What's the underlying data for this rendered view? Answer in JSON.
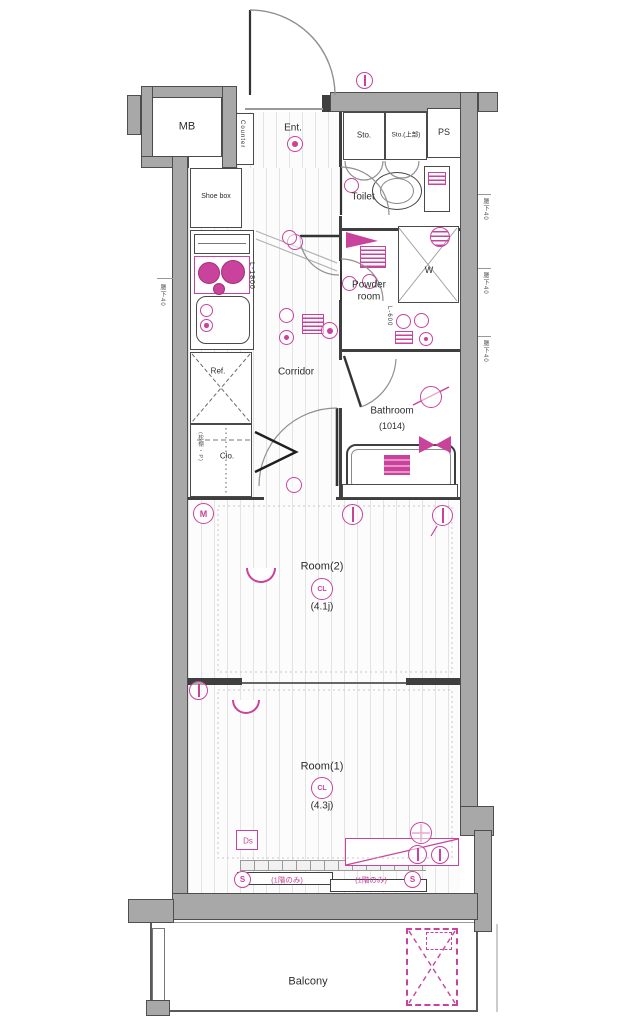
{
  "colors": {
    "pink": "#c9429c",
    "wall_fill": "#a8a8a8",
    "wall_edge": "#4e4e4e",
    "floor_line": "#e3e3e3"
  },
  "labels": {
    "mb": "MB",
    "ent": "Ent.",
    "counter": "Counter",
    "shoe_box": "Shoe box",
    "sto": "Sto.",
    "sto_upper": "Sto.(上部)",
    "ps": "PS",
    "toilet": "Toilet",
    "powder_room": "Powder room",
    "washer": "W",
    "corridor": "Corridor",
    "ref": "Ref.",
    "clo": "Clo.",
    "bathroom": "Bathroom",
    "bathroom_size": "(1014)",
    "room2": "Room(2)",
    "room2_size": "(4.1j)",
    "room1": "Room(1)",
    "room1_size": "(4.3j)",
    "balcony": "Balcony"
  },
  "symbols": {
    "cl": "CL",
    "s": "S",
    "m": "M",
    "ds": "Ds"
  },
  "annotations": {
    "counter_length": "L-1800",
    "vanity_length": "L-600",
    "first_floor_only": "(1階のみ)",
    "right_top": "腰下40",
    "right_middle": "腰下40",
    "right_bottom": "腰下40",
    "left_side": "腰下40",
    "closet_note": "(枕棚・P)"
  }
}
